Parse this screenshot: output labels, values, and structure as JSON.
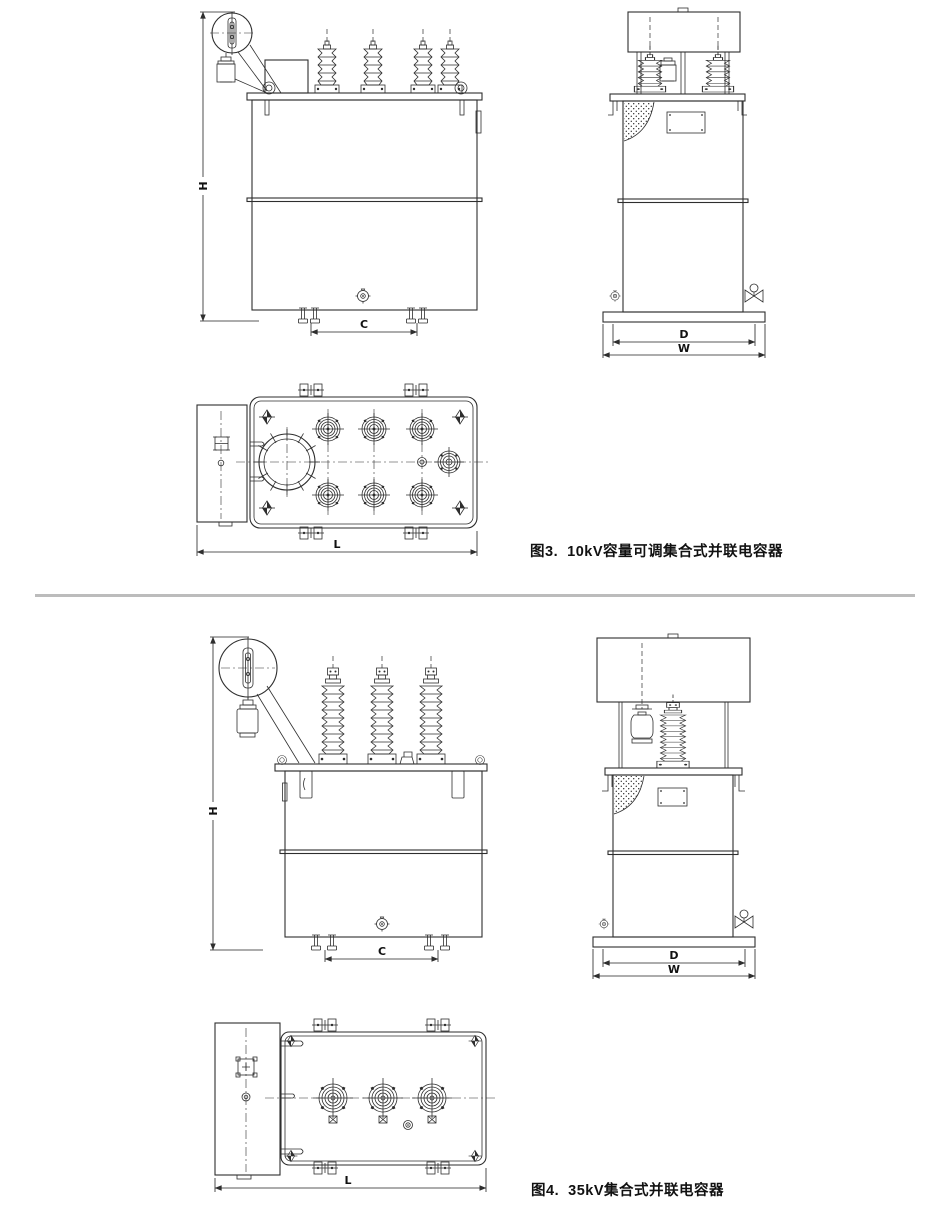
{
  "page": {
    "background": "#ffffff",
    "line_color": "#2e2e2e",
    "divider_color": "#bcbcbc"
  },
  "figure3": {
    "caption": "图3.  10kV容量可调集合式并联电容器",
    "front_view": {
      "dim_height": "H",
      "dim_foot_spacing": "C"
    },
    "side_view": {
      "dim_base_inner": "D",
      "dim_base_outer": "W"
    },
    "top_view": {
      "dim_length": "L"
    }
  },
  "figure4": {
    "caption": "图4.  35kV集合式并联电容器",
    "front_view": {
      "dim_height": "H",
      "dim_foot_spacing": "C"
    },
    "side_view": {
      "dim_base_inner": "D",
      "dim_base_outer": "W"
    },
    "top_view": {
      "dim_length": "L"
    }
  }
}
